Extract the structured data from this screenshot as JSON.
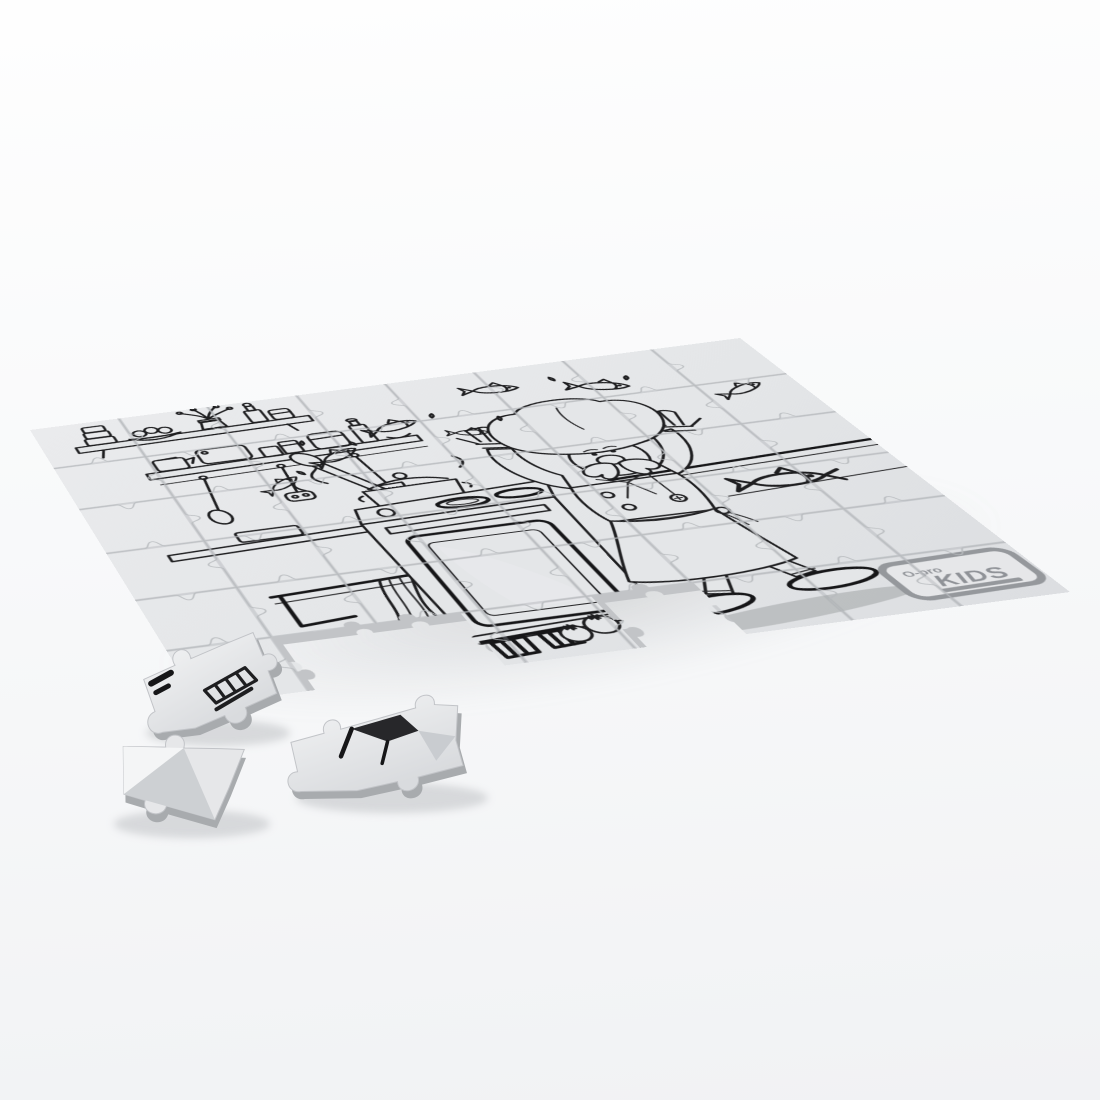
{
  "image_type": "product render (photo-style 3D mockup)",
  "scene": {
    "subject": "Blank gray cardboard jigsaw puzzle lying at an angle with black-and-white coloring-book artwork; several pieces detached near the lower-left corner",
    "artwork_theme": "Cartoon chef juggling fish in a kitchen",
    "artwork_elements": [
      "chef with tall puffy hat, big mustache, apron and raised arms",
      "several fish flying through the air",
      "fish lying on counter at right",
      "cooking pot with lid, paddle and steam swirls",
      "stove with two burners, oven door and striped feet",
      "wall shelves with jars, bowl of buns, potted plant and bottles",
      "hanging utensils: spoon, masher, ladle",
      "kitchen towel on a rail",
      "two tomatoes on the floor"
    ]
  },
  "puzzle": {
    "rows": 6,
    "cols": 8,
    "loose_pieces": 3,
    "missing_piece_gaps": 2
  },
  "logo": {
    "prefix": "O-pro",
    "title": "KIDS"
  },
  "colors": {
    "background": "#f8f9fa",
    "surface": "#e4e6e8",
    "surface_dark": "#dcdee1",
    "seam": "#b7babe",
    "groove": "#9ea2a7",
    "edge_side": "#c2c4c7",
    "line_art": "#1e1e20",
    "cast_shadow": "#a8abac"
  }
}
